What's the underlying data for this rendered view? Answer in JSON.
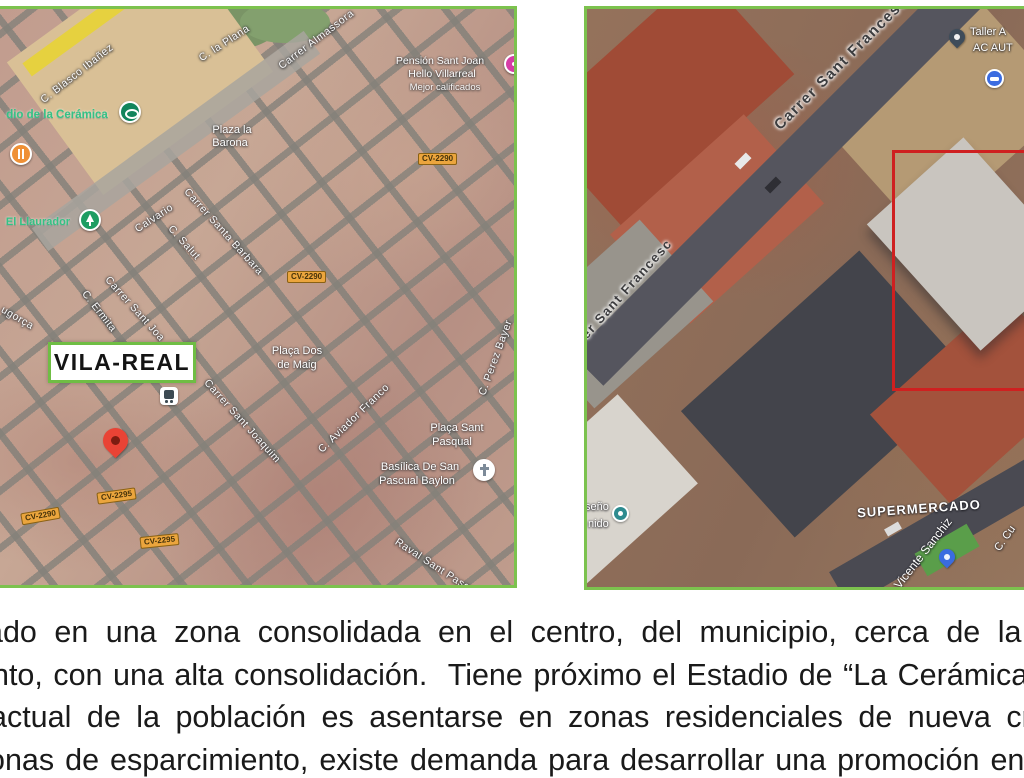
{
  "slide": {
    "paragraph_lines": [
      "ado en una zona consolidada en el centro, del municipio, cerca de la p",
      "nto, con una alta consolidación.  Tiene próximo el Estadio de “La Cerámica”",
      "actual de la población es asentarse en zonas residenciales de nueva crea",
      "onas de esparcimiento, existe demanda para desarrollar una promoción en e"
    ]
  },
  "left_map": {
    "city_label": "VILA-REAL",
    "streets": {
      "blasco": "C. Blasco Ibañez",
      "plana": "C. la Plana",
      "almassora": "Carrer Almassora",
      "calvario": "Calvario",
      "salut": "C. Salut",
      "santa_barbara": "Carrer Santa Barbara",
      "sant_joan": "Carrer Sant Joa",
      "ermita": "C. Ermita",
      "ugorca": "ugorça",
      "sant_joaquim": "Carrer Sant Joaquim",
      "aviador": "C. Aviador Franco",
      "perez_bayer": "C. Perez Bayer",
      "raval": "Raval Sant Pasqual"
    },
    "pois": {
      "ceramica": "dio de la Cerámica",
      "llaurador": "El Llaurador",
      "barona_1": "Plaza la",
      "barona_2": "Barona",
      "dos_maig_1": "Plaça Dos",
      "dos_maig_2": "de Maig",
      "sant_pasqual_1": "Plaça Sant",
      "sant_pasqual_2": "Pasqual",
      "basilica_1": "Basílica De San",
      "basilica_2": "Pascual Baylon",
      "pension_1": "Pensión Sant Joan",
      "pension_2": "Hello Villarreal",
      "pension_3": "Mejor calificados"
    },
    "road_badges": {
      "b1": "CV-2290",
      "b2": "CV-2290",
      "b3": "CV-2295",
      "b4": "CV-2290",
      "b5": "CV-2295"
    }
  },
  "right_map": {
    "streets": {
      "sant_francesc": "Carrer Sant Francesc",
      "sant_francesc_frag": "rer Sant Francesc",
      "vicente_sanchiz": "C. Vicente Sanchiz",
      "ccu": "C. Cu"
    },
    "pois": {
      "taller_1": "Taller A",
      "taller_2": "AC AUT",
      "supermercado": "SUPERMERCADO",
      "frag_seno": "seño",
      "frag_nido": "nido"
    }
  },
  "colors": {
    "map_border_green": "#7cc24e",
    "plot_outline_red": "#cf2020",
    "road_badge_orange": "#eba53d",
    "location_pin_red": "#e94335"
  }
}
